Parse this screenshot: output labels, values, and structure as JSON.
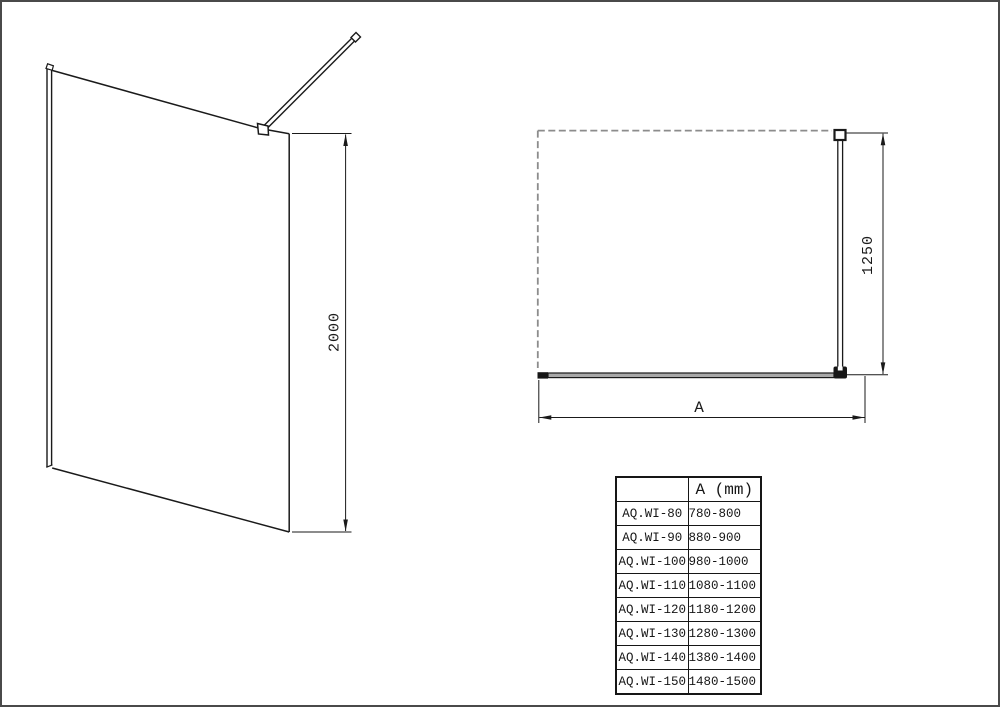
{
  "drawings": {
    "perspective_view": {
      "description": "walk-in glass shower panel with wall profile and ceiling support bar",
      "height_dimension_label": "2000"
    },
    "plan_view": {
      "description": "top view with dashed shower area outline, glass panel and support bar",
      "depth_dimension_label": "1250",
      "width_dimension_label": "A"
    }
  },
  "size_table": {
    "columns": [
      "",
      "A (mm)"
    ],
    "rows": [
      {
        "model": "AQ.WI-80",
        "a_range": "780-800"
      },
      {
        "model": "AQ.WI-90",
        "a_range": "880-900"
      },
      {
        "model": "AQ.WI-100",
        "a_range": "980-1000"
      },
      {
        "model": "AQ.WI-110",
        "a_range": "1080-1100"
      },
      {
        "model": "AQ.WI-120",
        "a_range": "1180-1200"
      },
      {
        "model": "AQ.WI-130",
        "a_range": "1280-1300"
      },
      {
        "model": "AQ.WI-140",
        "a_range": "1380-1400"
      },
      {
        "model": "AQ.WI-150",
        "a_range": "1480-1500"
      }
    ]
  },
  "colors": {
    "background": "#ffffff",
    "page_border": "#4a4a4a",
    "line": "#1a1a1a",
    "dashed_outline": "#8c8c8c",
    "glass_fill": "#a8a8a8"
  }
}
